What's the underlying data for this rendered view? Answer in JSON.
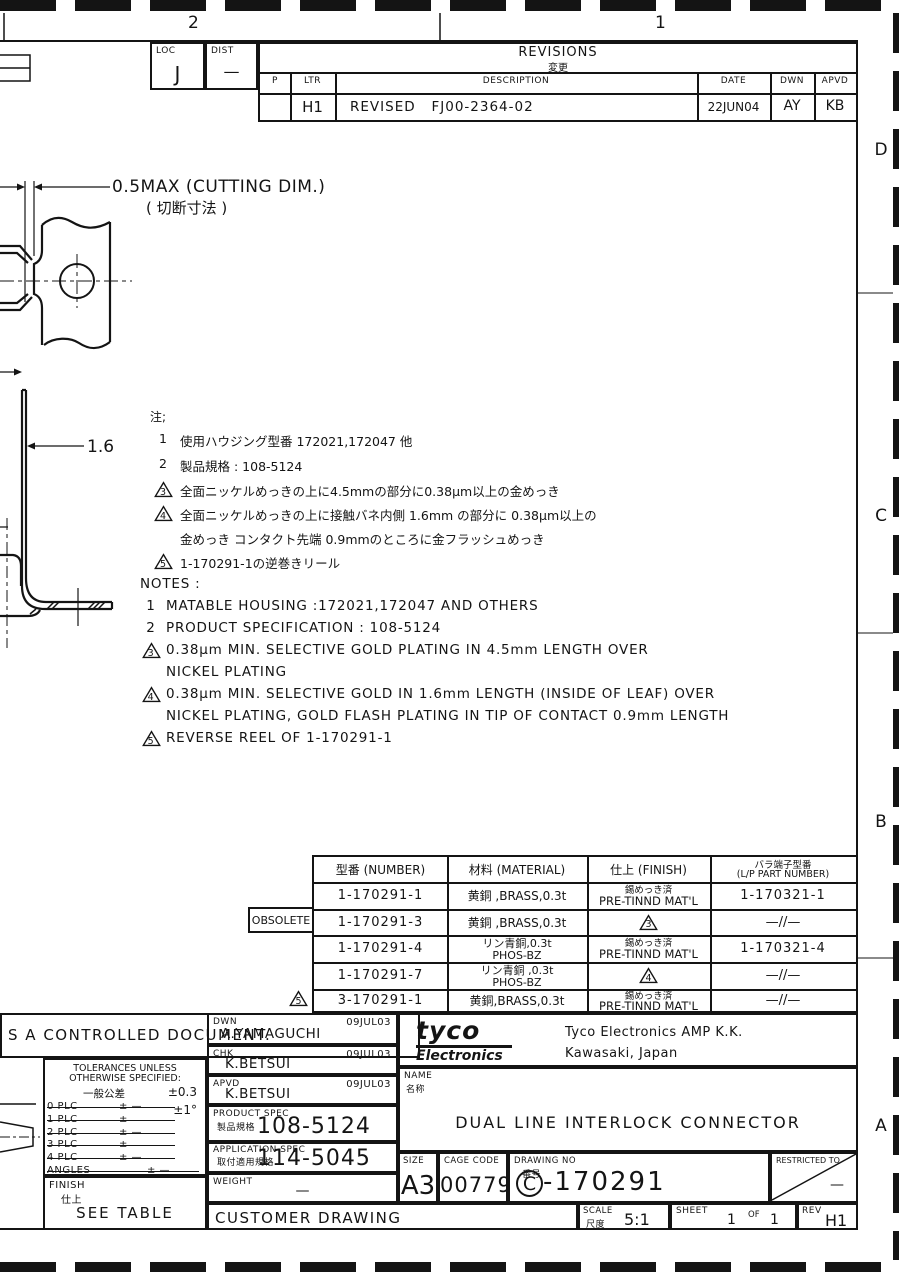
{
  "zones": {
    "top_left": "2",
    "top_right": "1",
    "right_d": "D",
    "right_c": "C",
    "right_b": "B",
    "right_a": "A"
  },
  "loc": {
    "label": "LOC",
    "value": "J"
  },
  "dist": {
    "label": "DIST",
    "value": "—"
  },
  "revisions": {
    "title": "REVISIONS",
    "title_jp": "変更",
    "col_p": "P",
    "col_ltr": "LTR",
    "col_description": "DESCRIPTION",
    "col_date": "DATE",
    "col_dwn": "DWN",
    "col_apvd": "APVD",
    "row": {
      "ltr": "H1",
      "description": "REVISED   FJ00-2364-02",
      "date": "22JUN04",
      "dwn": "AY",
      "apvd": "KB"
    }
  },
  "drawing": {
    "dim_cutting": "0.5MAX (CUTTING DIM.)",
    "dim_cutting_jp": "( 切断寸法 )",
    "dim_leaf": "1.6"
  },
  "notes_jp": {
    "heading": "注;",
    "items": [
      {
        "marker": "1",
        "line1": "使用ハウジング型番  172021,172047 他"
      },
      {
        "marker": "2",
        "line1": "製品規格 : 108-5124"
      },
      {
        "marker": "3",
        "line1": "全面ニッケルめっきの上に4.5mmの部分に0.38μm以上の金めっき"
      },
      {
        "marker": "4",
        "line1": "全面ニッケルめっきの上に接触バネ内側 1.6mm の部分に 0.38μm以上の",
        "line2": "金めっき  コンタクト先端 0.9mmのところに金フラッシュめっき"
      },
      {
        "marker": "5",
        "line1": "1-170291-1の逆巻きリール"
      }
    ]
  },
  "notes_en": {
    "heading": "NOTES :",
    "items": [
      {
        "marker": "1",
        "line1": "MATABLE HOUSING :172021,172047 AND OTHERS"
      },
      {
        "marker": "2",
        "line1": "PRODUCT SPECIFICATION : 108-5124"
      },
      {
        "marker": "3",
        "line1": "0.38μm MIN. SELECTIVE GOLD PLATING IN 4.5mm LENGTH OVER",
        "line2": "NICKEL PLATING"
      },
      {
        "marker": "4",
        "line1": "0.38μm MIN. SELECTIVE GOLD IN 1.6mm LENGTH (INSIDE OF LEAF) OVER",
        "line2": "NICKEL PLATING, GOLD FLASH PLATING IN TIP OF CONTACT 0.9mm LENGTH"
      },
      {
        "marker": "5",
        "line1": "REVERSE REEL OF 1-170291-1"
      }
    ]
  },
  "parts_table": {
    "col_number": "型番 (NUMBER)",
    "col_material": "材料 (MATERIAL)",
    "col_finish": "仕上 (FINISH)",
    "col_lp_1": "バラ端子型番",
    "col_lp_2": "(L/P PART NUMBER)",
    "obsolete_label": "OBSOLETE",
    "row5_marker": "5",
    "rows": [
      {
        "number": "1-170291-1",
        "material_1": "黄銅 ,BRASS,0.3t",
        "finish_jp": "錫めっき済",
        "finish_en": "PRE-TINND MAT'L",
        "lp": "1-170321-1"
      },
      {
        "number": "1-170291-3",
        "material_1": "黄銅 ,BRASS,0.3t",
        "finish_marker": "3",
        "lp": "—//—"
      },
      {
        "number": "1-170291-4",
        "material_1": "リン青銅,0.3t",
        "material_2": "PHOS-BZ",
        "finish_jp": "錫めっき済",
        "finish_en": "PRE-TINND MAT'L",
        "lp": "1-170321-4"
      },
      {
        "number": "1-170291-7",
        "material_1": "リン青銅 ,0.3t",
        "material_2": "PHOS-BZ",
        "finish_marker": "4",
        "lp": "—//—"
      },
      {
        "number": "3-170291-1",
        "material_1": "黄銅,BRASS,0.3t",
        "finish_jp": "錫めっき済",
        "finish_en": "PRE-TINND MAT'L",
        "lp": "—//—"
      }
    ]
  },
  "title_block": {
    "controlled_doc": "S A CONTROLLED DOCUMENT.",
    "tolerances": {
      "line1": "TOLERANCES UNLESS",
      "line2": "OTHERWISE SPECIFIED:",
      "general_jp": "一般公差",
      "tol_linear": "±0.3",
      "tol_angle": "±1°",
      "plc_rows": [
        {
          "name": "0 PLC",
          "value": "± —"
        },
        {
          "name": "1 PLC",
          "value": "±"
        },
        {
          "name": "2 PLC",
          "value": "± —"
        },
        {
          "name": "3 PLC",
          "value": "±"
        },
        {
          "name": "4 PLC",
          "value": "± —"
        },
        {
          "name": "ANGLES",
          "value": "± —"
        }
      ]
    },
    "finish": {
      "label": "FINISH",
      "label_jp": "仕上",
      "value": "SEE TABLE"
    },
    "dwn": {
      "label": "DWN",
      "name": "A.YAMAGUCHI",
      "date": "09JUL03"
    },
    "chk": {
      "label": "CHK",
      "name": "K.BETSUI",
      "date": "09JUL03"
    },
    "apvd": {
      "label": "APVD",
      "name": "K.BETSUI",
      "date": "09JUL03"
    },
    "product_spec": {
      "label": "PRODUCT SPEC",
      "label_jp": "製品規格",
      "value": "108-5124"
    },
    "application_spec": {
      "label": "APPLICATION SPEC",
      "label_jp": "取付適用規格",
      "value": "114-5045"
    },
    "weight": {
      "label": "WEIGHT",
      "value": "—"
    },
    "customer_drawing": "CUSTOMER DRAWING",
    "company": {
      "logo_top": "tyco",
      "logo_bottom": "Electronics",
      "name": "Tyco Electronics AMP K.K.",
      "location": "Kawasaki, Japan"
    },
    "name": {
      "label": "NAME",
      "label_jp": "名称",
      "value": "DUAL LINE INTERLOCK CONNECTOR"
    },
    "size": {
      "label": "SIZE",
      "value": "A3"
    },
    "cage_code": {
      "label": "CAGE CODE",
      "value": "00779"
    },
    "drawing_no": {
      "label": "DRAWING NO",
      "label_jp": "番号",
      "prefix": "C",
      "number": "-170291"
    },
    "restricted_to": {
      "label": "RESTRICTED TO",
      "value": "—"
    },
    "scale": {
      "label": "SCALE",
      "label_jp": "尺度",
      "value": "5:1"
    },
    "sheet": {
      "label": "SHEET",
      "num": "1",
      "of": "OF",
      "total": "1"
    },
    "rev": {
      "label": "REV",
      "value": "H1"
    }
  }
}
